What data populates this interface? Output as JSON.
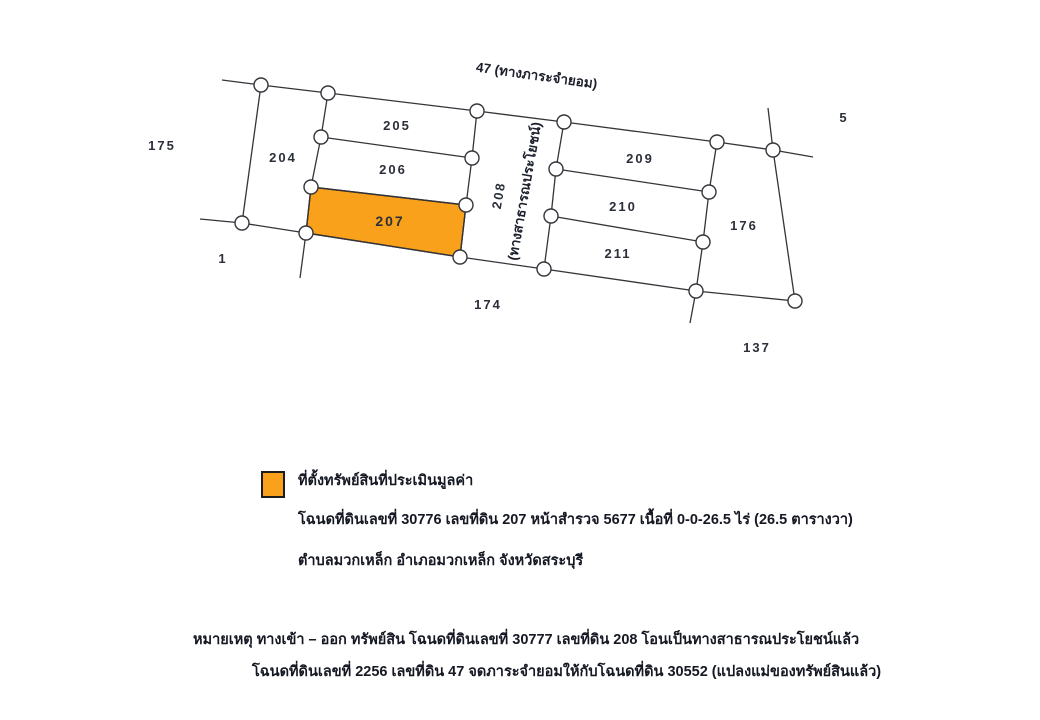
{
  "diagram": {
    "top_road_label": "47 (ทางภาระจำยอม)",
    "vertical_road_number": "208",
    "vertical_road_name": "(ทางสาธารณประโยชน์)",
    "highlight_color": "#F9A11B",
    "line_color": "#33353a",
    "parcels": {
      "p204": "204",
      "p205": "205",
      "p206": "206",
      "p207": "207",
      "p209": "209",
      "p210": "210",
      "p211": "211",
      "p176": "176"
    },
    "neighbors": {
      "n175": "175",
      "n1": "1",
      "n174": "174",
      "n137": "137",
      "n5": "5"
    }
  },
  "legend": {
    "swatch_color": "#F9A11B",
    "title": "ที่ตั้งทรัพย์สินที่ประเมินมูลค่า",
    "deed_line": "โฉนดที่ดินเลขที่ 30776 เลขที่ดิน 207 หน้าสำรวจ 5677 เนื้อที่ 0-0-26.5 ไร่ (26.5 ตารางวา)",
    "location_line": "ตำบลมวกเหล็ก  อำเภอมวกเหล็ก  จังหวัดสระบุรี"
  },
  "notes": {
    "line1": "หมายเหตุ ทางเข้า – ออก ทรัพย์สิน โฉนดที่ดินเลขที่ 30777 เลขที่ดิน 208 โอนเป็นทางสาธารณประโยชน์แล้ว",
    "line2": "โฉนดที่ดินเลขที่ 2256 เลขที่ดิน 47 จดภาระจำยอมให้กับโฉนดที่ดิน 30552 (แปลงแม่ของทรัพย์สินแล้ว)"
  }
}
